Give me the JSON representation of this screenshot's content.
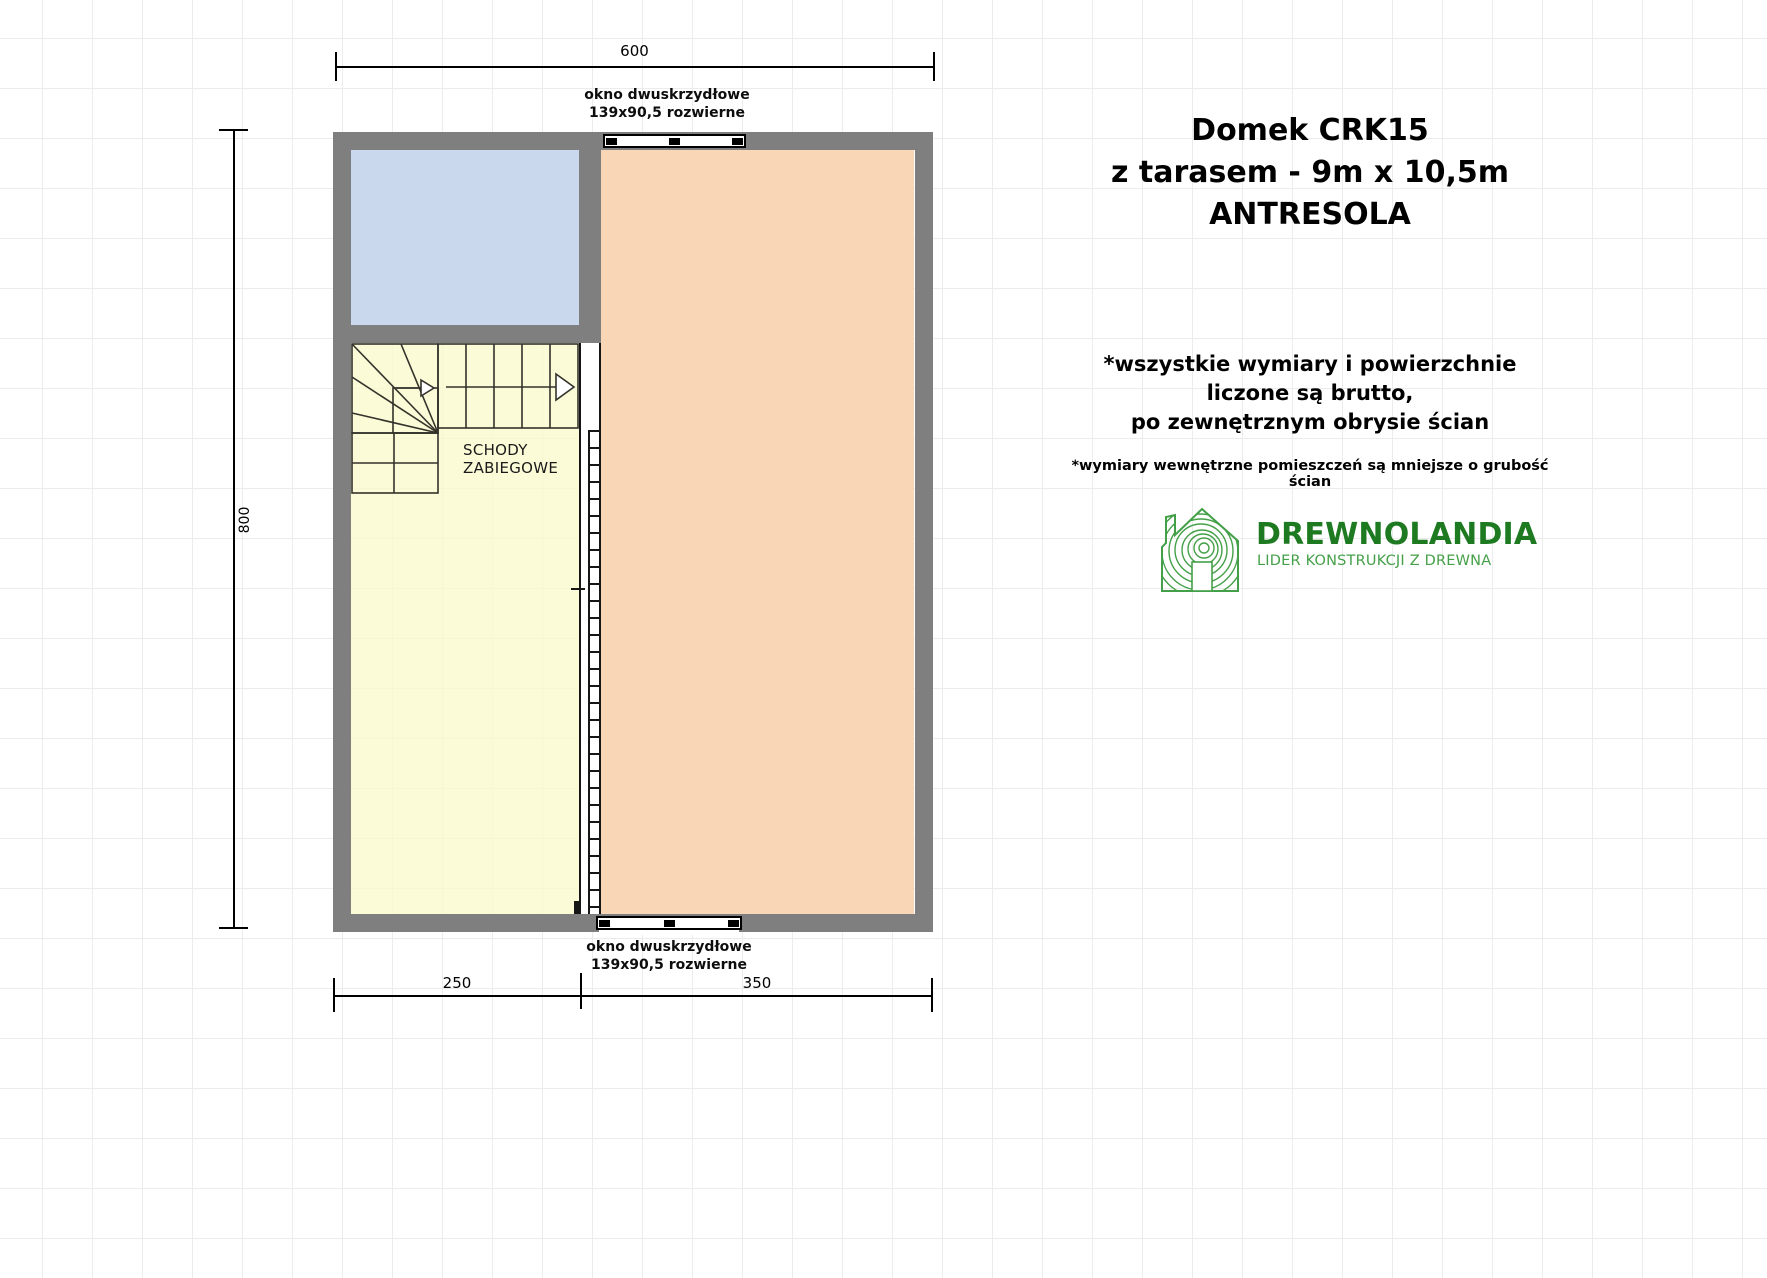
{
  "title": {
    "line1": "Domek CRK15",
    "line2": "z tarasem -  9m x 10,5m",
    "line3": "ANTRESOLA"
  },
  "notes": {
    "line1": "*wszystkie wymiary i powierzchnie",
    "line2": "liczone są brutto,",
    "line3": "po zewnętrznym obrysie ścian",
    "small": "*wymiary wewnętrzne pomieszczeń są mniejsze o grubość ścian"
  },
  "logo": {
    "name": "DREWNOLANDIA",
    "tagline": "LIDER KONSTRUKCJI Z DREWNA"
  },
  "plan": {
    "dim_top": "600",
    "dim_left": "800",
    "dim_bottom_left": "250",
    "dim_bottom_right": "350",
    "window_top": {
      "line1": "okno dwuskrzydłowe",
      "line2": "139x90,5 rozwierne"
    },
    "window_bottom": {
      "line1": "okno dwuskrzydłowe",
      "line2": "139x90,5 rozwierne"
    },
    "stairs": {
      "line1": "SCHODY",
      "line2": "ZABIEGOWE"
    }
  },
  "colors": {
    "wall": "#7f7f7f",
    "room_blue": "#c9d8ec",
    "room_peach": "#f8d4b0",
    "room_yellow": "#fbfad3",
    "stairs_line": "#33332b",
    "logo_green_dark": "#1d7a21",
    "logo_green_light": "#44a048"
  }
}
